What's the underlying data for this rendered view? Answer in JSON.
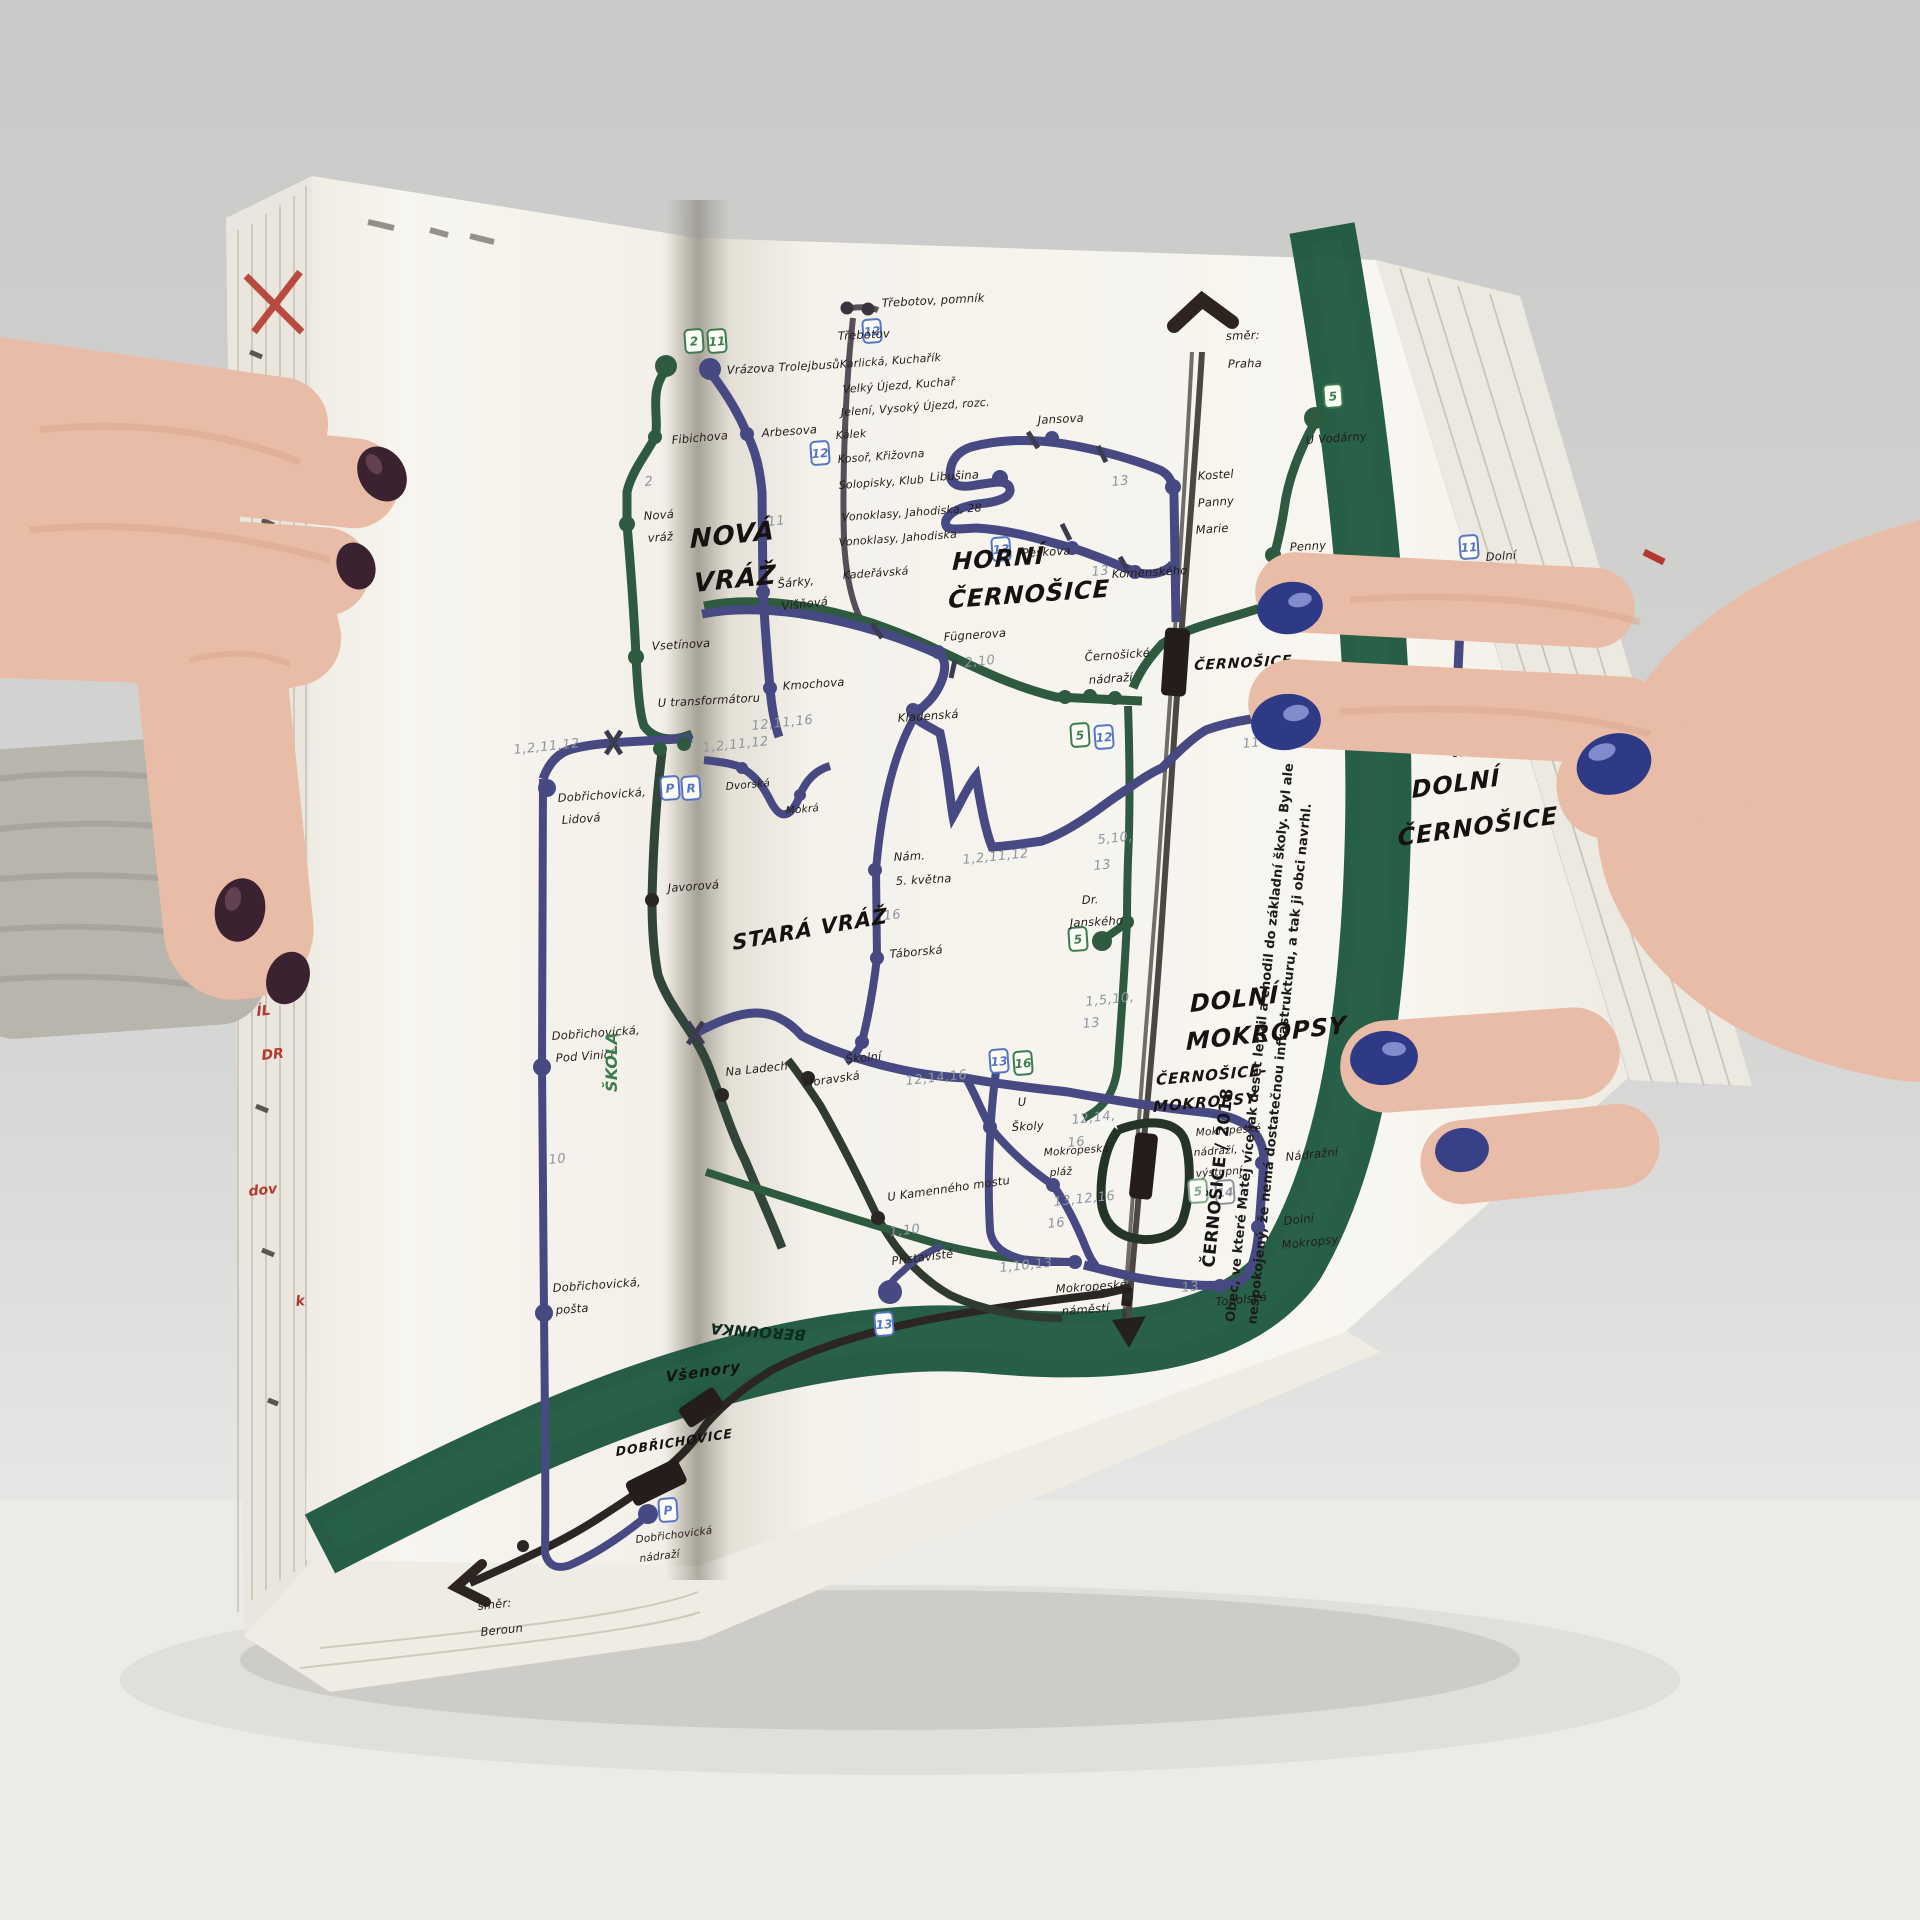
{
  "colors": {
    "ink": "#241c1a",
    "line_green": "#2e5a40",
    "dark_green": "#31453a",
    "line_purple": "#474a82",
    "line_black": "#2b2523",
    "rail_gray": "#4c4742",
    "river": "#17523a",
    "river_text": "#0d2c1e",
    "pencil": "#8d95a0",
    "badge_green": "#3c7d4e",
    "badge_blue": "#5575c5",
    "red": "#b5382e",
    "yellow": "#d9c93a",
    "nail_navy": "#2e3a85",
    "nail_dark": "#3b2231",
    "skin": "#e9bca7",
    "skin_shadow": "#d9a48c",
    "sleeve": "#b8b5ad",
    "page": "#f6f4ee",
    "backdrop": "#cfd0ce",
    "table": "#e9e9e7"
  },
  "caption": {
    "title": "ČERNOŠICE / 2018",
    "line1": "Obec, ve které Matěj více jak deset let žil a chodil do základní školy. Byl ale",
    "line2": "nespokojený, že nemá dostatečnou infrastrukturu, a tak ji obci navrhl."
  },
  "map": {
    "big_labels": [
      {
        "t": "NOVÁ",
        "x": 690,
        "y": 548,
        "s": 26,
        "r": -6
      },
      {
        "t": "VRÁŽ",
        "x": 694,
        "y": 592,
        "s": 26,
        "r": -6
      },
      {
        "t": "STARÁ VRÁŽ",
        "x": 733,
        "y": 950,
        "s": 21,
        "r": -10
      },
      {
        "t": "HORNÍ",
        "x": 952,
        "y": 570,
        "s": 24,
        "r": -4
      },
      {
        "t": "ČERNOŠICE",
        "x": 948,
        "y": 608,
        "s": 24,
        "r": -4
      },
      {
        "t": "DOLNÍ",
        "x": 1190,
        "y": 1012,
        "s": 24,
        "r": -6
      },
      {
        "t": "MOKROPSY",
        "x": 1186,
        "y": 1050,
        "s": 24,
        "r": -6
      },
      {
        "t": "DOLNÍ",
        "x": 1412,
        "y": 798,
        "s": 24,
        "r": -8
      },
      {
        "t": "ČERNOŠICE",
        "x": 1398,
        "y": 846,
        "s": 24,
        "r": -8
      },
      {
        "t": "ČERNOŠICE-",
        "x": 1156,
        "y": 1085,
        "s": 15,
        "r": -5
      },
      {
        "t": "MOKROPSY",
        "x": 1153,
        "y": 1112,
        "s": 15,
        "r": -5
      },
      {
        "t": "ČERNOŠICE",
        "x": 1194,
        "y": 670,
        "s": 14,
        "r": -3
      },
      {
        "t": "DOBŘICHOVICE",
        "x": 616,
        "y": 1456,
        "s": 12.5,
        "r": -9
      },
      {
        "t": "Všenory",
        "x": 666,
        "y": 1382,
        "s": 15,
        "r": -8
      }
    ],
    "labels": [
      {
        "t": "Vrázova Trolejbusů",
        "x": 727,
        "y": 374,
        "r": -3
      },
      {
        "t": "Fibichova",
        "x": 672,
        "y": 444,
        "r": -5
      },
      {
        "t": "Nová",
        "x": 644,
        "y": 520,
        "r": -4
      },
      {
        "t": "vráž",
        "x": 648,
        "y": 542,
        "r": -4
      },
      {
        "t": "Vsetínova",
        "x": 652,
        "y": 650,
        "r": -3
      },
      {
        "t": "U transformátoru",
        "x": 658,
        "y": 707,
        "r": -3
      },
      {
        "t": "Arbesova",
        "x": 762,
        "y": 437,
        "r": -4
      },
      {
        "t": "Šárky,",
        "x": 778,
        "y": 588,
        "r": -6
      },
      {
        "t": "Višňová",
        "x": 782,
        "y": 610,
        "r": -6
      },
      {
        "t": "Kmochova",
        "x": 783,
        "y": 690,
        "r": -4
      },
      {
        "t": "Dobřichovická,",
        "x": 558,
        "y": 802,
        "r": -4
      },
      {
        "t": "Lidová",
        "x": 562,
        "y": 824,
        "r": -4
      },
      {
        "t": "Javorová",
        "x": 668,
        "y": 892,
        "r": -4
      },
      {
        "t": "Na Ladech",
        "x": 726,
        "y": 1076,
        "r": -6
      },
      {
        "t": "Dobřichovická,",
        "x": 552,
        "y": 1040,
        "r": -4
      },
      {
        "t": "Pod Vinicí",
        "x": 556,
        "y": 1062,
        "r": -4
      },
      {
        "t": "Dobřichovická,",
        "x": 553,
        "y": 1292,
        "r": -4
      },
      {
        "t": "pošta",
        "x": 556,
        "y": 1314,
        "r": -4
      },
      {
        "t": "Dobřichovická",
        "x": 636,
        "y": 1543,
        "r": -7,
        "s": 10.5
      },
      {
        "t": "nádraží",
        "x": 640,
        "y": 1562,
        "r": -7,
        "s": 10.5
      },
      {
        "t": "směr:",
        "x": 478,
        "y": 1610,
        "r": -6
      },
      {
        "t": "Beroun",
        "x": 481,
        "y": 1636,
        "r": -6
      },
      {
        "t": "Dvorská",
        "x": 726,
        "y": 790,
        "r": -5,
        "s": 10.5
      },
      {
        "t": "Mokrá",
        "x": 786,
        "y": 814,
        "r": -5,
        "s": 10.5
      },
      {
        "t": "Třebotov, pomník",
        "x": 882,
        "y": 307,
        "r": -3
      },
      {
        "t": "Třebotov",
        "x": 838,
        "y": 340,
        "r": -3
      },
      {
        "t": "Karlická, Kuchařík",
        "x": 840,
        "y": 368,
        "r": -4,
        "s": 11
      },
      {
        "t": "Velký Újezd, Kuchař",
        "x": 843,
        "y": 393,
        "r": -4,
        "s": 11
      },
      {
        "t": "Jelení, Vysoký Újezd, rozc.",
        "x": 841,
        "y": 416,
        "r": -4,
        "s": 11
      },
      {
        "t": "Kálek",
        "x": 836,
        "y": 439,
        "r": -4,
        "s": 11
      },
      {
        "t": "Kosoř, Křižovna",
        "x": 838,
        "y": 463,
        "r": -4,
        "s": 11
      },
      {
        "t": "Solopisky, Klub",
        "x": 839,
        "y": 489,
        "r": -4,
        "s": 11
      },
      {
        "t": "Vonoklasy, Jahodiska, 28",
        "x": 842,
        "y": 521,
        "r": -4,
        "s": 11
      },
      {
        "t": "Vonoklasy, Jahodiska",
        "x": 839,
        "y": 546,
        "r": -4,
        "s": 11
      },
      {
        "t": "Kadeřávská",
        "x": 843,
        "y": 579,
        "r": -4,
        "s": 11
      },
      {
        "t": "Jansova",
        "x": 1038,
        "y": 424,
        "r": -3
      },
      {
        "t": "Libušina",
        "x": 930,
        "y": 481,
        "r": -3
      },
      {
        "t": "Kostel",
        "x": 1198,
        "y": 480,
        "r": -4
      },
      {
        "t": "Panny",
        "x": 1198,
        "y": 507,
        "r": -4
      },
      {
        "t": "Marie",
        "x": 1196,
        "y": 534,
        "r": -4
      },
      {
        "t": "směr:",
        "x": 1226,
        "y": 340,
        "r": -2
      },
      {
        "t": "Praha",
        "x": 1228,
        "y": 368,
        "r": -2
      },
      {
        "t": "Peškova",
        "x": 1022,
        "y": 557,
        "r": -3
      },
      {
        "t": "Komenského",
        "x": 1112,
        "y": 578,
        "r": -3
      },
      {
        "t": "U Vodárny",
        "x": 1306,
        "y": 444,
        "r": -4
      },
      {
        "t": "Penny",
        "x": 1290,
        "y": 551,
        "r": -3
      },
      {
        "t": "market",
        "x": 1292,
        "y": 573,
        "r": -3
      },
      {
        "t": "5",
        "x": 1280,
        "y": 592,
        "r": 0,
        "c": "green",
        "s": 14
      },
      {
        "t": "Fügnerova",
        "x": 944,
        "y": 641,
        "r": -4
      },
      {
        "t": "Černošické",
        "x": 1085,
        "y": 661,
        "r": -4
      },
      {
        "t": "nádraží",
        "x": 1089,
        "y": 684,
        "r": -4
      },
      {
        "t": "Kladenská",
        "x": 898,
        "y": 722,
        "r": -4
      },
      {
        "t": "Dolno-",
        "x": 1459,
        "y": 734,
        "r": -4
      },
      {
        "t": "černošická",
        "x": 1452,
        "y": 757,
        "r": -4
      },
      {
        "t": "Dolní",
        "x": 1486,
        "y": 561,
        "r": -4
      },
      {
        "t": "Černošice",
        "x": 1478,
        "y": 585,
        "r": -4
      },
      {
        "t": "Nám.",
        "x": 894,
        "y": 861,
        "r": -3
      },
      {
        "t": "5. května",
        "x": 896,
        "y": 885,
        "r": -3
      },
      {
        "t": "Táborská",
        "x": 890,
        "y": 958,
        "r": -5
      },
      {
        "t": "Dr.",
        "x": 1082,
        "y": 904,
        "r": -3
      },
      {
        "t": "Janského",
        "x": 1070,
        "y": 927,
        "r": -3
      },
      {
        "t": "Školní",
        "x": 846,
        "y": 1063,
        "r": -5
      },
      {
        "t": "Moravská",
        "x": 804,
        "y": 1087,
        "r": -8
      },
      {
        "t": "U",
        "x": 1018,
        "y": 1106,
        "r": -3
      },
      {
        "t": "Školy",
        "x": 1012,
        "y": 1131,
        "r": -3
      },
      {
        "t": "U Kamenného mostu",
        "x": 888,
        "y": 1201,
        "r": -8
      },
      {
        "t": "Mokropeská",
        "x": 1044,
        "y": 1156,
        "r": -4,
        "s": 10.5
      },
      {
        "t": "pláž",
        "x": 1050,
        "y": 1176,
        "r": -4,
        "s": 10.5
      },
      {
        "t": "Mokropeské",
        "x": 1196,
        "y": 1136,
        "r": -4,
        "s": 10.5
      },
      {
        "t": "nádraží,",
        "x": 1194,
        "y": 1156,
        "r": -4,
        "s": 10.5
      },
      {
        "t": "výstupní",
        "x": 1196,
        "y": 1177,
        "r": -4,
        "s": 10.5
      },
      {
        "t": "Nádražní",
        "x": 1286,
        "y": 1161,
        "r": -6
      },
      {
        "t": "Dolní",
        "x": 1284,
        "y": 1225,
        "r": -6
      },
      {
        "t": "Mokropsy",
        "x": 1282,
        "y": 1249,
        "r": -6
      },
      {
        "t": "Topolská",
        "x": 1216,
        "y": 1306,
        "r": -6
      },
      {
        "t": "Mokropeské",
        "x": 1056,
        "y": 1293,
        "r": -4
      },
      {
        "t": "náměstí",
        "x": 1062,
        "y": 1315,
        "r": -4
      },
      {
        "t": "Přístaviště",
        "x": 892,
        "y": 1265,
        "r": -7
      },
      {
        "t": "ŠKOLA",
        "x": 617,
        "y": 1092,
        "r": -90,
        "c": "green",
        "s": 16,
        "w": 1
      },
      {
        "t": "BEROUNKA",
        "x": 806,
        "y": 1330,
        "r": 184,
        "c": "river_text",
        "s": 15,
        "w": 1
      }
    ],
    "pencil": [
      {
        "t": "2",
        "x": 645,
        "y": 486
      },
      {
        "t": "11",
        "x": 768,
        "y": 526
      },
      {
        "t": "1,2,11,12",
        "x": 514,
        "y": 754
      },
      {
        "t": "1,2,11,12",
        "x": 703,
        "y": 752
      },
      {
        "t": "12,11,16",
        "x": 752,
        "y": 730
      },
      {
        "t": "10",
        "x": 549,
        "y": 1164
      },
      {
        "t": "13",
        "x": 1112,
        "y": 486
      },
      {
        "t": "13",
        "x": 1092,
        "y": 576
      },
      {
        "t": "2,10",
        "x": 965,
        "y": 667
      },
      {
        "t": "11",
        "x": 1243,
        "y": 748
      },
      {
        "t": "1,2,11,12",
        "x": 963,
        "y": 864
      },
      {
        "t": "5,10,",
        "x": 1098,
        "y": 844
      },
      {
        "t": "13",
        "x": 1094,
        "y": 870
      },
      {
        "t": "16",
        "x": 884,
        "y": 920
      },
      {
        "t": "12,14,16",
        "x": 906,
        "y": 1085
      },
      {
        "t": "1,5,10,",
        "x": 1086,
        "y": 1006
      },
      {
        "t": "13",
        "x": 1083,
        "y": 1028
      },
      {
        "t": "12,14,",
        "x": 1072,
        "y": 1124
      },
      {
        "t": "16",
        "x": 1068,
        "y": 1147
      },
      {
        "t": "13,12,16",
        "x": 1054,
        "y": 1206
      },
      {
        "t": "16",
        "x": 1048,
        "y": 1228
      },
      {
        "t": "1,10",
        "x": 890,
        "y": 1236
      },
      {
        "t": "1,10,13",
        "x": 1000,
        "y": 1272
      },
      {
        "t": "13",
        "x": 1182,
        "y": 1292
      }
    ],
    "badges": [
      {
        "t": "2",
        "x": 694,
        "y": 341,
        "i": "g"
      },
      {
        "t": "11",
        "x": 717,
        "y": 341,
        "i": "g"
      },
      {
        "t": "12",
        "x": 872,
        "y": 331,
        "i": "b"
      },
      {
        "t": "12",
        "x": 820,
        "y": 453,
        "i": "b"
      },
      {
        "t": "13",
        "x": 1001,
        "y": 549,
        "i": "b"
      },
      {
        "t": "5",
        "x": 1333,
        "y": 396,
        "i": "g"
      },
      {
        "t": "5",
        "x": 1080,
        "y": 735,
        "i": "g"
      },
      {
        "t": "12",
        "x": 1104,
        "y": 737,
        "i": "b"
      },
      {
        "t": "5",
        "x": 1078,
        "y": 939,
        "i": "g"
      },
      {
        "t": "13",
        "x": 999,
        "y": 1061,
        "i": "b"
      },
      {
        "t": "16",
        "x": 1023,
        "y": 1063,
        "i": "g"
      },
      {
        "t": "5",
        "x": 1198,
        "y": 1191,
        "i": "pg"
      },
      {
        "t": "14",
        "x": 1225,
        "y": 1192,
        "i": "pc"
      },
      {
        "t": "11",
        "x": 1469,
        "y": 547,
        "i": "b"
      },
      {
        "t": "13",
        "x": 884,
        "y": 1324,
        "i": "b"
      },
      {
        "t": "P",
        "x": 670,
        "y": 788,
        "i": "b"
      },
      {
        "t": "R",
        "x": 691,
        "y": 788,
        "i": "b"
      },
      {
        "t": "P",
        "x": 668,
        "y": 1510,
        "i": "b"
      }
    ],
    "stops": [
      {
        "x": 666,
        "y": 366,
        "r": 11,
        "c": "g"
      },
      {
        "x": 710,
        "y": 369,
        "r": 11,
        "c": "p"
      },
      {
        "x": 655,
        "y": 437,
        "r": 7,
        "c": "g"
      },
      {
        "x": 627,
        "y": 524,
        "r": 8,
        "c": "g"
      },
      {
        "x": 636,
        "y": 657,
        "r": 8,
        "c": "g"
      },
      {
        "x": 747,
        "y": 434,
        "r": 7,
        "c": "p"
      },
      {
        "x": 763,
        "y": 592,
        "r": 7,
        "c": "p"
      },
      {
        "x": 770,
        "y": 688,
        "r": 7,
        "c": "p"
      },
      {
        "x": 660,
        "y": 749,
        "r": 7,
        "c": "g"
      },
      {
        "x": 684,
        "y": 744,
        "r": 7,
        "c": "g"
      },
      {
        "x": 547,
        "y": 788,
        "r": 9,
        "c": "p"
      },
      {
        "x": 542,
        "y": 1067,
        "r": 9,
        "c": "p"
      },
      {
        "x": 544,
        "y": 1313,
        "r": 9,
        "c": "p"
      },
      {
        "x": 648,
        "y": 1514,
        "r": 10,
        "c": "p"
      },
      {
        "x": 523,
        "y": 1546,
        "r": 6,
        "c": "k"
      },
      {
        "x": 652,
        "y": 900,
        "r": 7,
        "c": "k"
      },
      {
        "x": 722,
        "y": 1095,
        "r": 7,
        "c": "k"
      },
      {
        "x": 742,
        "y": 768,
        "r": 6,
        "c": "p"
      },
      {
        "x": 800,
        "y": 795,
        "r": 6,
        "c": "p"
      },
      {
        "x": 938,
        "y": 652,
        "r": 7,
        "c": "p"
      },
      {
        "x": 913,
        "y": 710,
        "r": 7,
        "c": "p"
      },
      {
        "x": 875,
        "y": 870,
        "r": 7,
        "c": "p"
      },
      {
        "x": 877,
        "y": 958,
        "r": 7,
        "c": "p"
      },
      {
        "x": 862,
        "y": 1042,
        "r": 7,
        "c": "p"
      },
      {
        "x": 808,
        "y": 1078,
        "r": 7,
        "c": "k"
      },
      {
        "x": 878,
        "y": 1218,
        "r": 7,
        "c": "k"
      },
      {
        "x": 1052,
        "y": 438,
        "r": 7,
        "c": "p"
      },
      {
        "x": 1000,
        "y": 478,
        "r": 8,
        "c": "p"
      },
      {
        "x": 1173,
        "y": 487,
        "r": 8,
        "c": "p"
      },
      {
        "x": 1135,
        "y": 572,
        "r": 7,
        "c": "p"
      },
      {
        "x": 1072,
        "y": 548,
        "r": 7,
        "c": "p"
      },
      {
        "x": 1315,
        "y": 418,
        "r": 11,
        "c": "g"
      },
      {
        "x": 1273,
        "y": 555,
        "r": 8,
        "c": "g"
      },
      {
        "x": 1065,
        "y": 697,
        "r": 7,
        "c": "g"
      },
      {
        "x": 1090,
        "y": 696,
        "r": 7,
        "c": "g"
      },
      {
        "x": 1115,
        "y": 698,
        "r": 7,
        "c": "g"
      },
      {
        "x": 1127,
        "y": 922,
        "r": 7,
        "c": "g"
      },
      {
        "x": 1102,
        "y": 941,
        "r": 10,
        "c": "g"
      },
      {
        "x": 1455,
        "y": 722,
        "r": 9,
        "c": "p"
      },
      {
        "x": 1462,
        "y": 572,
        "r": 11,
        "c": "p"
      },
      {
        "x": 990,
        "y": 1127,
        "r": 7,
        "c": "p"
      },
      {
        "x": 1053,
        "y": 1185,
        "r": 7,
        "c": "p"
      },
      {
        "x": 1262,
        "y": 1163,
        "r": 7,
        "c": "p"
      },
      {
        "x": 1258,
        "y": 1227,
        "r": 7,
        "c": "p"
      },
      {
        "x": 1220,
        "y": 1286,
        "r": 7,
        "c": "p"
      },
      {
        "x": 1075,
        "y": 1262,
        "r": 7,
        "c": "p"
      },
      {
        "x": 890,
        "y": 1292,
        "r": 8,
        "c": "p"
      },
      {
        "x": 1128,
        "y": 1297,
        "r": 5,
        "c": "k"
      }
    ],
    "edge_marks": [
      {
        "t": "A 3",
        "x": 252,
        "y": 928
      },
      {
        "t": "RÁN",
        "x": 249,
        "y": 972
      },
      {
        "t": "ÍL",
        "x": 257,
        "y": 1016
      },
      {
        "t": "DR",
        "x": 262,
        "y": 1060
      },
      {
        "t": "dov",
        "x": 249,
        "y": 1196
      },
      {
        "t": "k",
        "x": 296,
        "y": 1306
      }
    ]
  }
}
